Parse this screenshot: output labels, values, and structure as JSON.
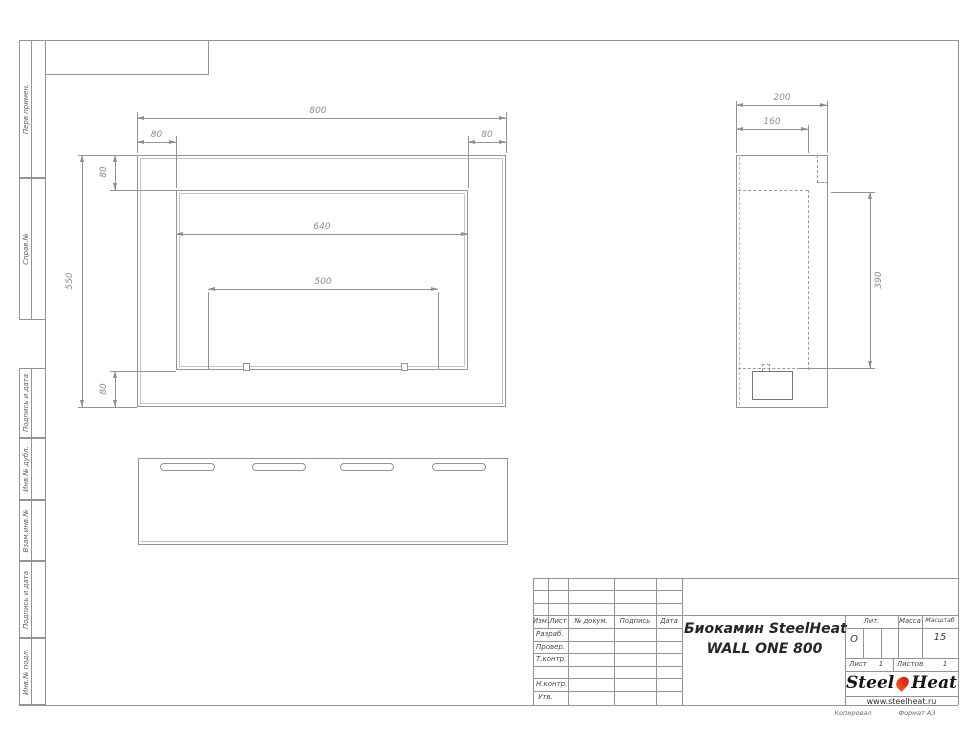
{
  "drawing": {
    "dims_front": {
      "width_total": "800",
      "flange_left": "80",
      "flange_right": "80",
      "flange_top": "80",
      "height_total": "550",
      "opening_width": "640",
      "burner_width": "500",
      "flange_bottom": "80"
    },
    "dims_side": {
      "depth_total": "200",
      "depth_inner": "160",
      "opening_height": "390"
    }
  },
  "sidebar": {
    "labels": [
      "Перв.примен.",
      "Справ.№",
      "Подпись и дата",
      "Инв.№ дубл.",
      "Взам.инв.№",
      "Подпись и дата",
      "Инв.№ подл."
    ]
  },
  "title_block": {
    "change_cols": [
      "Изм.",
      "Лист",
      "№ докум.",
      "Подпись",
      "Дата"
    ],
    "roles": [
      "Разраб.",
      "Провер.",
      "Т.контр.",
      "Н.контр.",
      "Утв."
    ],
    "title_line1": "Биокамин SteelHeat",
    "title_line2": "WALL ONE 800",
    "lit_label": "Лит.",
    "lit_value": "О",
    "mass_label": "Масса",
    "scale_label": "Масштаб",
    "scale_value": "15",
    "sheet_label": "Лист",
    "sheet_value": "1",
    "sheets_label": "Листов",
    "sheets_value": "1",
    "logo": {
      "word1": "Steel",
      "word2": "Heat",
      "site": "www.steelheat.ru",
      "flame_color": "#e0391f"
    },
    "footer": {
      "copied": "Копировал",
      "format": "Формат А3"
    }
  }
}
